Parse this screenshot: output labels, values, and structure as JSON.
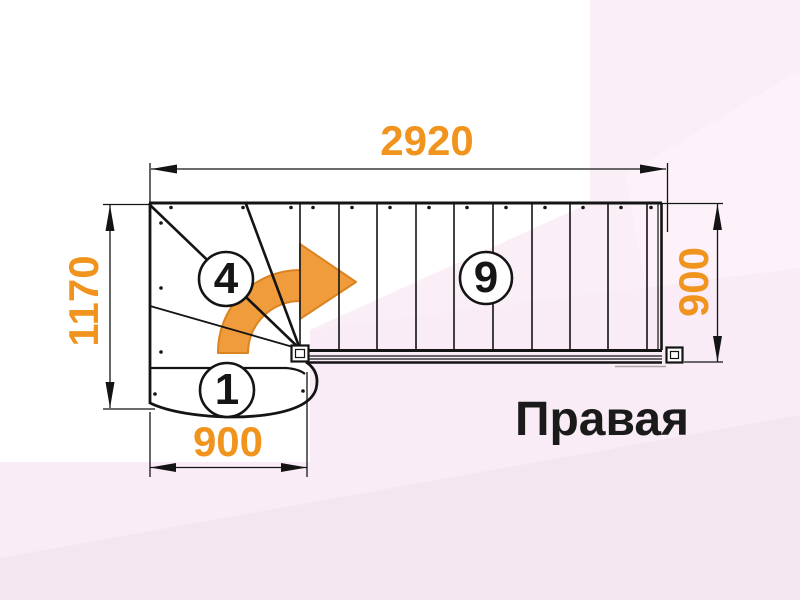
{
  "title": {
    "text": "Правая"
  },
  "dimensions": {
    "top_width": "2920",
    "left_height": "1170",
    "right_height": "900",
    "bottom_width": "900"
  },
  "steps": {
    "first": "1",
    "winder_last": "4",
    "flight_last": "9"
  },
  "icons": {
    "turn_arrow": "turn-direction-arrow"
  },
  "colors": {
    "dimension_orange": "#F0941E",
    "arrow_orange": "#F09C3C",
    "arrow_outline": "#DA8320",
    "line_black": "#141414",
    "background_pink": "#F4E6EF",
    "background_white": "#FFFFFF"
  }
}
